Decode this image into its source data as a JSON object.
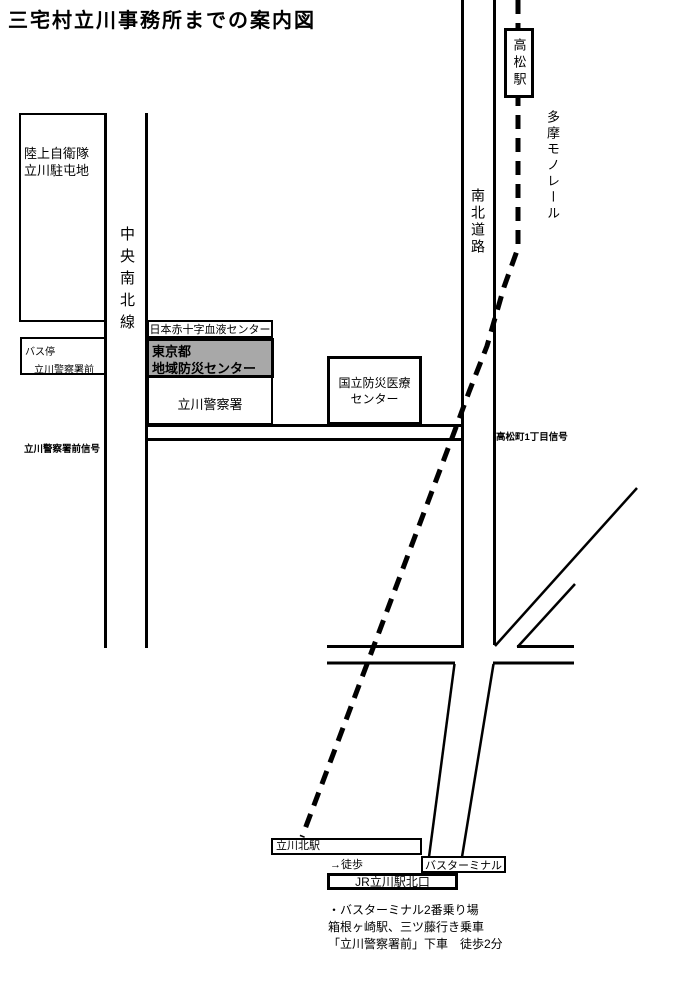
{
  "title": "三宅村立川事務所までの案内図",
  "colors": {
    "ink": "#000000",
    "paper": "#ffffff",
    "highlight_fill": "#a8a8a8"
  },
  "boxes": {
    "takamatsu_station": "高松駅",
    "garrison": {
      "line1": "陸上自衛隊",
      "line2": "立川駐屯地"
    },
    "bus_stop": {
      "line1": "バス停",
      "line2": "立川警察署前"
    },
    "blood_center": "日本赤十字血液センター",
    "disaster_center": {
      "line1": "東京都",
      "line2": "地域防災センター"
    },
    "police_station": "立川警察署",
    "national_medical": {
      "line1": "国立防災医療",
      "line2": "センター"
    },
    "tachikawa_kita_station": "立川北駅",
    "bus_terminal": "バスターミナル",
    "jr_north_exit": "JR立川駅北口"
  },
  "road_labels": {
    "chuo_nanboku_line": "中央南北線",
    "nanboku_road": "南北道路",
    "tama_monorail": "多摩モノレール"
  },
  "signals": {
    "police_front": "立川警察署前信号",
    "takamatsucho_1chome": "高松町1丁目信号"
  },
  "walk_label": "→徒歩",
  "notes": [
    "・バスターミナル2番乗り場",
    "箱根ヶ崎駅、三ツ藤行き乗車",
    "「立川警察署前」下車　徒歩2分"
  ]
}
